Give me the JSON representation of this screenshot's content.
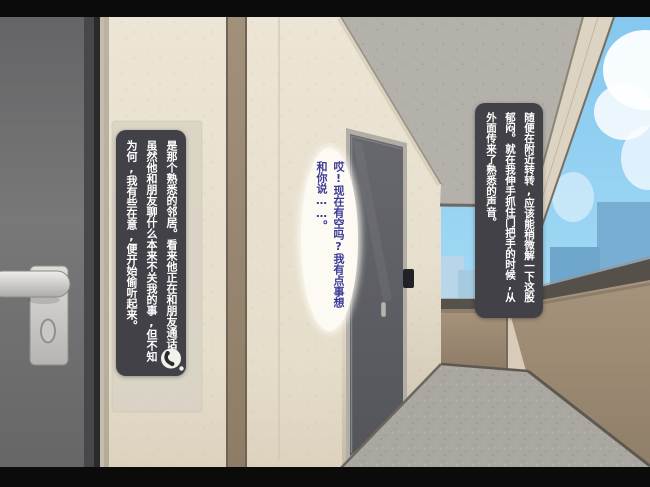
{
  "scene": {
    "description": "first-person visual-novel CG: exterior apartment corridor, own door at left, neighbor hallway receding to open sky with parapet railing",
    "letterbox_color": "#0b0b0b"
  },
  "narration_right": {
    "text": "随便在附近转转,应该能稍微解一下这股郁闷。就在我伸手抓住门把手的时候,从外面传来了熟悉的声音。",
    "bg_color": "#424147",
    "text_color": "#ffffff"
  },
  "narration_left": {
    "text": "是那个熟悉的邻居。看来他正在和朋友通话。虽然他和朋友聊什么本来不关我的事,但不知为何,我有些在意,便开始偷听起来。",
    "bg_color": "#424147",
    "text_color": "#ffffff",
    "icon": "phone-receiver-icon"
  },
  "speech_bubble": {
    "text": "哎!现在有空吗?我有点事想和你说……。",
    "bg_color": "#fcfaf3",
    "text_color": "#3c3a99"
  },
  "palette": {
    "wall_beige": "#ece5d5",
    "wall_stripe_brown": "#9a8a72",
    "ceiling_gray": "#b4b1ab",
    "beam_cream": "#ddd3c2",
    "floor_gray": "#aaa7a1",
    "parapet_tan": "#a6937c",
    "rail_dark": "#55504a",
    "door_gray": "#6e6e70",
    "sky_blue": "#8ecdf0",
    "building_blue": "#79aed3"
  }
}
